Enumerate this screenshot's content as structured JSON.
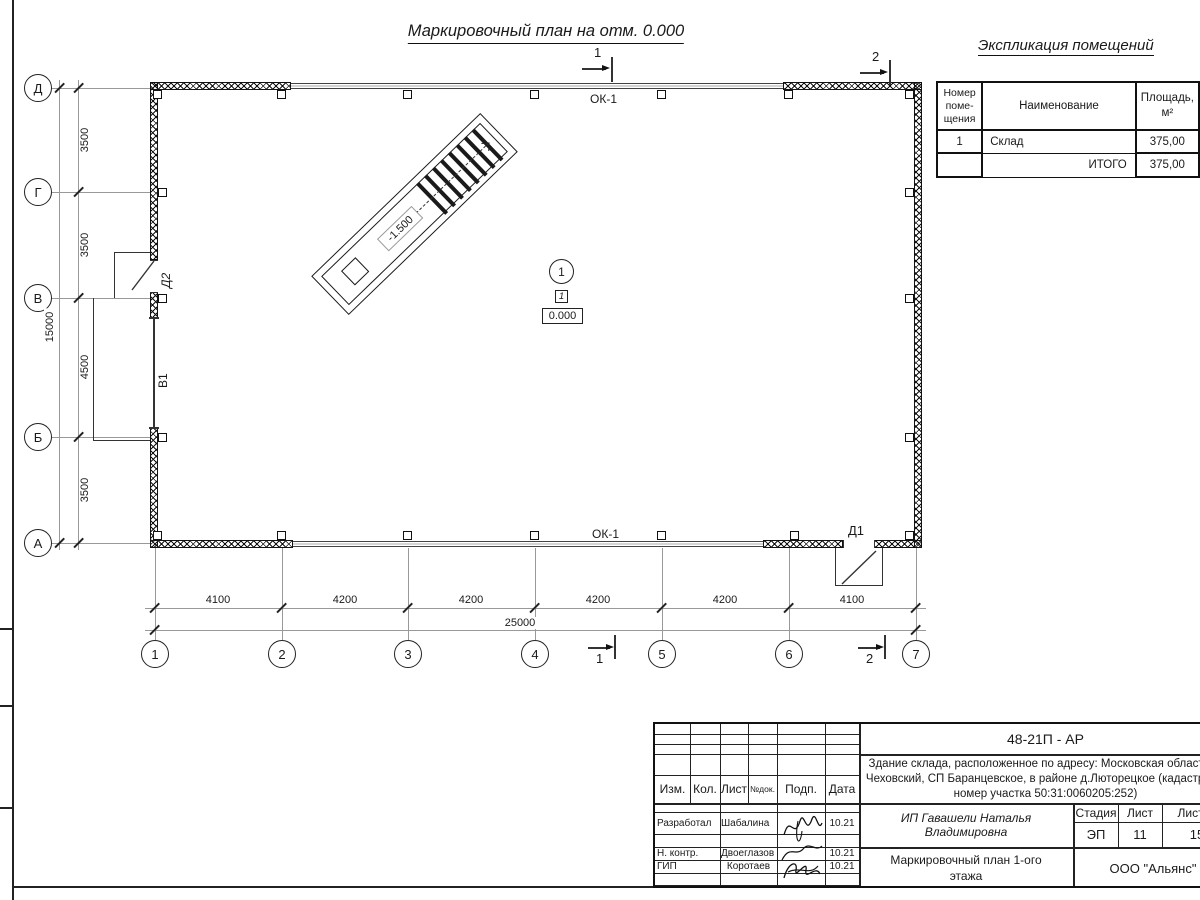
{
  "sheet": {
    "main_title": "Маркировочный план на отм. 0.000"
  },
  "plan": {
    "axes_vertical": [
      "Д",
      "Г",
      "В",
      "Б",
      "А"
    ],
    "axes_horizontal": [
      "1",
      "2",
      "3",
      "4",
      "5",
      "6",
      "7"
    ],
    "dims_vertical": [
      "3500",
      "3500",
      "4500",
      "3500"
    ],
    "dim_vertical_total": "15000",
    "dims_horizontal": [
      "4100",
      "4200",
      "4200",
      "4200",
      "4200",
      "4100"
    ],
    "dim_horizontal_total": "25000",
    "labels": {
      "window_top": "ОК-1",
      "window_bottom": "ОК-1",
      "door_left": "Д2",
      "gate_left": "В1",
      "door_bottom": "Д1",
      "ramp_level": "-1.500",
      "room_number_bubble": "1",
      "room_number_box": "1",
      "floor_level": "0.000",
      "section1": "1",
      "section2": "2"
    }
  },
  "explication": {
    "title": "Экспликация  помещений",
    "headers": {
      "number": "Номер\nпоме-\nщения",
      "name": "Наименование",
      "area": "Площадь,\nм²"
    },
    "rows": [
      {
        "number": "1",
        "name": "Склад",
        "area": "375,00"
      },
      {
        "number": "",
        "name": "ИТОГО",
        "area": "375,00"
      }
    ]
  },
  "titleblock": {
    "code": "48-21П - АР",
    "object_description": "Здание склада, расположенное по адресу: Московская область, р\nЧеховский, СП Баранцевское, в районе д.Люторецкое  (кадастровы\nномер участка 50:31:0060205:252)",
    "header_cols": {
      "izm": "Изм.",
      "kol": "Кол.",
      "list": "Лист",
      "ndok": "№док.",
      "podp": "Подп.",
      "data": "Дата"
    },
    "rows": [
      {
        "role": "Разработал",
        "name": "Шабалина",
        "date": "10.21"
      },
      {
        "role": "Н. контр.",
        "name": "Двоеглазов",
        "date": "10.21"
      },
      {
        "role": "ГИП",
        "name": "Коротаев",
        "date": "10.21"
      }
    ],
    "designer": "ИП Гавашели Наталья Владимировна",
    "stage_label": "Стадия",
    "sheet_label": "Лист",
    "sheets_label": "Листов",
    "stage": "ЭП",
    "sheet_no": "11",
    "sheets_total": "15",
    "drawing_name": "Маркировочный план 1-ого\nэтажа",
    "company": "ООО \"Альянс\""
  }
}
